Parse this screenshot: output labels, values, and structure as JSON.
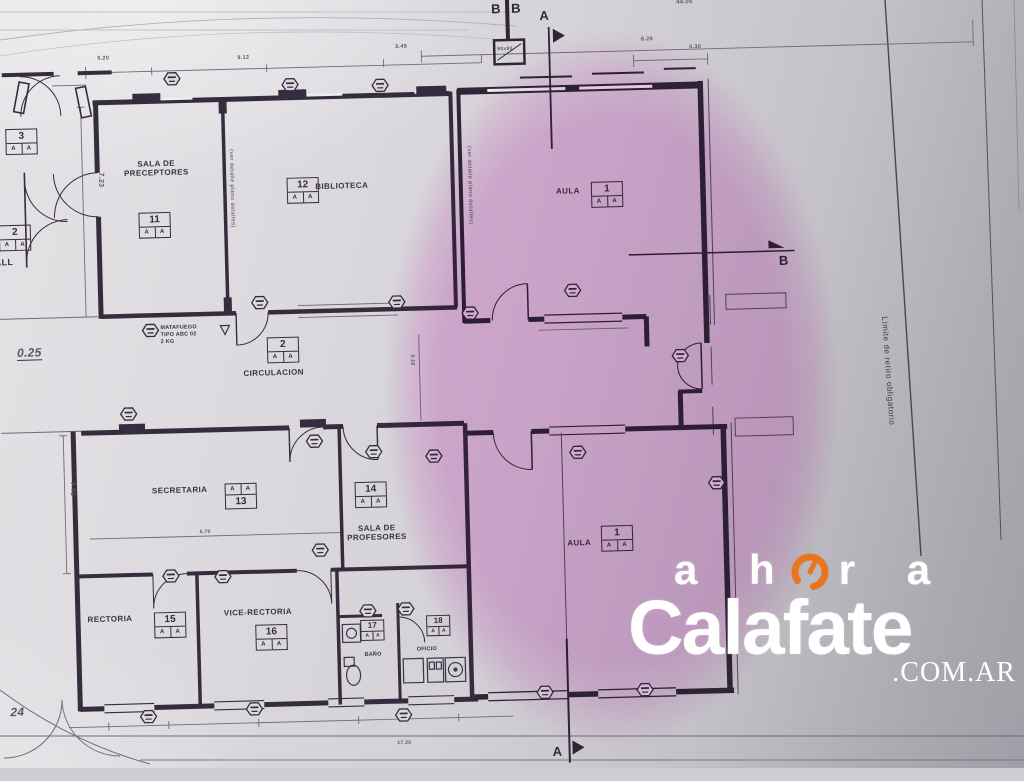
{
  "watermark": {
    "word": "ahora",
    "brand": "Calafate",
    "suffix": ".COM.AR",
    "accent_color": "#e8761e"
  },
  "rooms": {
    "preceptores": {
      "name": "SALA DE PRECEPTORES",
      "num": "11",
      "sub": "A A"
    },
    "biblioteca": {
      "name": "BIBLIOTECA",
      "num": "12",
      "sub": "A A"
    },
    "aula_top": {
      "name": "AULA",
      "num": "1",
      "sub": "A A"
    },
    "circulacion": {
      "name": "CIRCULACION",
      "num": "2",
      "sub": "A A"
    },
    "secretaria": {
      "name": "SECRETARIA",
      "num": "13",
      "sub": "A A"
    },
    "profesores": {
      "name": "SALA DE PROFESORES",
      "num": "14",
      "sub": "A A"
    },
    "rectoria": {
      "name": "RECTORIA",
      "num": "15",
      "sub": "A A"
    },
    "vice": {
      "name": "VICE-RECTORIA",
      "num": "16",
      "sub": "A A"
    },
    "bano": {
      "name": "BAÑO",
      "num": "17",
      "sub": "A A"
    },
    "oficio": {
      "name": "OFICIO",
      "num": "18",
      "sub": "A A"
    },
    "aula_bottom": {
      "name": "AULA",
      "num": "1",
      "sub": "A A"
    },
    "hall": {
      "name": "ALL",
      "num3": "3",
      "num2": "2",
      "sub": "A A"
    }
  },
  "annotations": {
    "matafuego_l1": "MATAFUEGO",
    "matafuego_l2": "TIPO ABC 02",
    "matafuego_l3": "2 KG",
    "wall_note": "(ver detalle plano detalles)",
    "limite": "Límite de retiro obligatorio",
    "column_tag": "90x90"
  },
  "sections": {
    "a": "A",
    "b": "B"
  },
  "dims": {
    "top1": "5.20",
    "top2": "9.12",
    "top3": "3.49",
    "top4": "6.20",
    "top5": "0.30",
    "top_right": "44.05",
    "left_v1": "7.23",
    "left_v2": "3.92",
    "secretaria_w": "5.70",
    "corridor_h": "6.10",
    "level": "0.25",
    "bottom_left": "24",
    "bottom_total": "17.26"
  },
  "colors": {
    "ink": "#352c3e",
    "highlight_pink": "#f3c8ee",
    "paper": "#d8d6da"
  }
}
